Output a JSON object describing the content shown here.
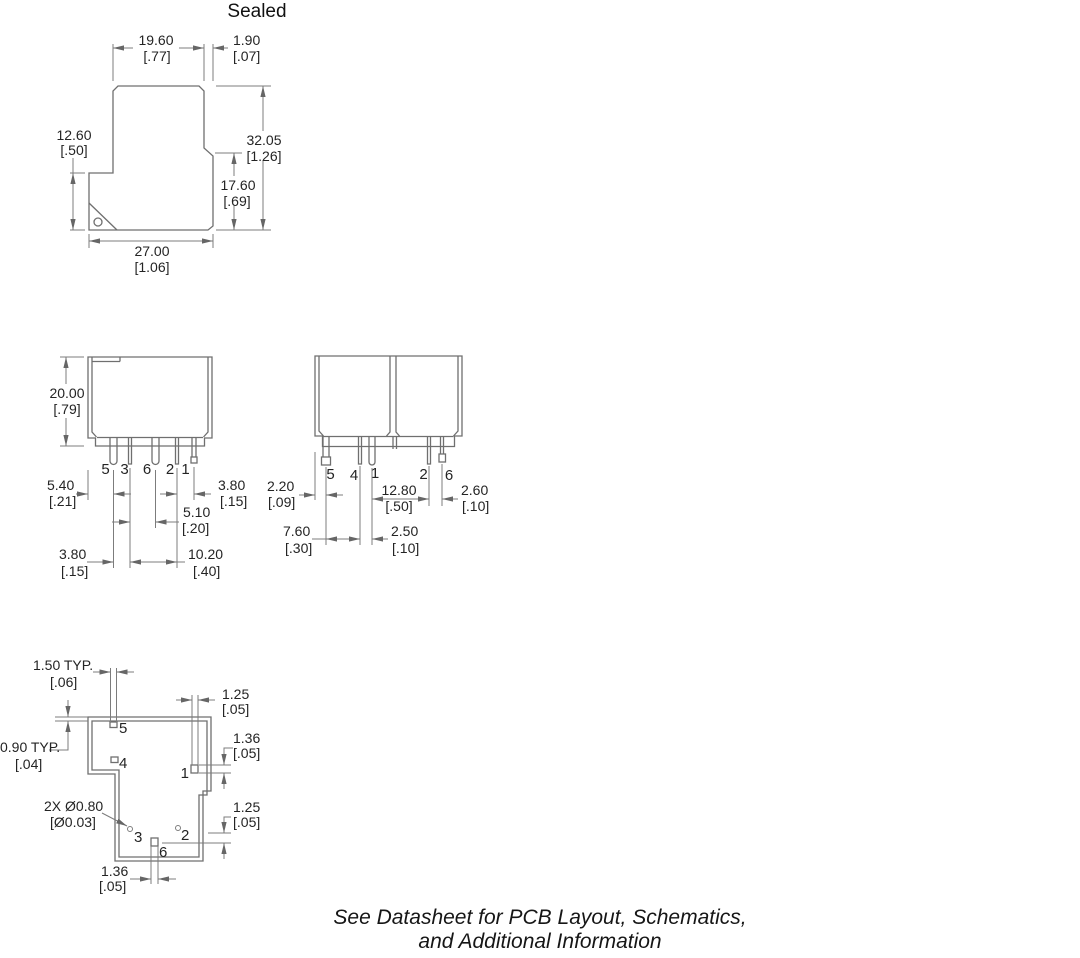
{
  "title": "Sealed",
  "footer": {
    "line1": "See Datasheet for PCB Layout, Schematics,",
    "line2": "and Additional Information"
  },
  "side_view": {
    "w_top": {
      "mm": "19.60",
      "in": "[.77]"
    },
    "flange": {
      "mm": "1.90",
      "in": "[.07]"
    },
    "h_left": {
      "mm": "12.60",
      "in": "[.50]"
    },
    "h_total": {
      "mm": "32.05",
      "in": "[1.26]"
    },
    "h_right": {
      "mm": "17.60",
      "in": "[.69]"
    },
    "w_bottom": {
      "mm": "27.00",
      "in": "[1.06]"
    }
  },
  "front_view": {
    "height": {
      "mm": "20.00",
      "in": "[.79]"
    },
    "edge_to_pin5": {
      "mm": "5.40",
      "in": "[.21]"
    },
    "pin2_to_pin1": {
      "mm": "3.80",
      "in": "[.15]"
    },
    "pin3_to_pin6": {
      "mm": "5.10",
      "in": "[.20]"
    },
    "pin5_to_pin3": {
      "mm": "3.80",
      "in": "[.15]"
    },
    "pin3_to_pin2": {
      "mm": "10.20",
      "in": "[.40]"
    },
    "pins": [
      "5",
      "3",
      "6",
      "2",
      "1"
    ]
  },
  "end_view": {
    "edge_to_pin5": {
      "mm": "2.20",
      "in": "[.09]"
    },
    "pin1_to_pin2": {
      "mm": "12.80",
      "in": "[.50]"
    },
    "pin2_to_pin6": {
      "mm": "2.60",
      "in": "[.10]"
    },
    "pin5_to_pin4": {
      "mm": "7.60",
      "in": "[.30]"
    },
    "pin4_to_pin1": {
      "mm": "2.50",
      "in": "[.10]"
    },
    "pins": [
      "5",
      "4",
      "1",
      "2",
      "6"
    ]
  },
  "pcb_view": {
    "pad_width_typ": {
      "mm": "1.50 TYP.",
      "in": "[.06]"
    },
    "pad1_width": {
      "mm": "1.25",
      "in": "[.05]"
    },
    "outline_offset_typ": {
      "mm": "0.90 TYP.",
      "in": "[.04]"
    },
    "hole_dia": {
      "mm": "2X Ø0.80",
      "in": "[Ø0.03]"
    },
    "pad1_height": {
      "mm": "1.36",
      "in": "[.05]"
    },
    "pad6_height": {
      "mm": "1.25",
      "in": "[.05]"
    },
    "pad6_width": {
      "mm": "1.36",
      "in": "[.05]"
    },
    "pins": [
      "5",
      "4",
      "1",
      "3",
      "2",
      "6"
    ]
  }
}
